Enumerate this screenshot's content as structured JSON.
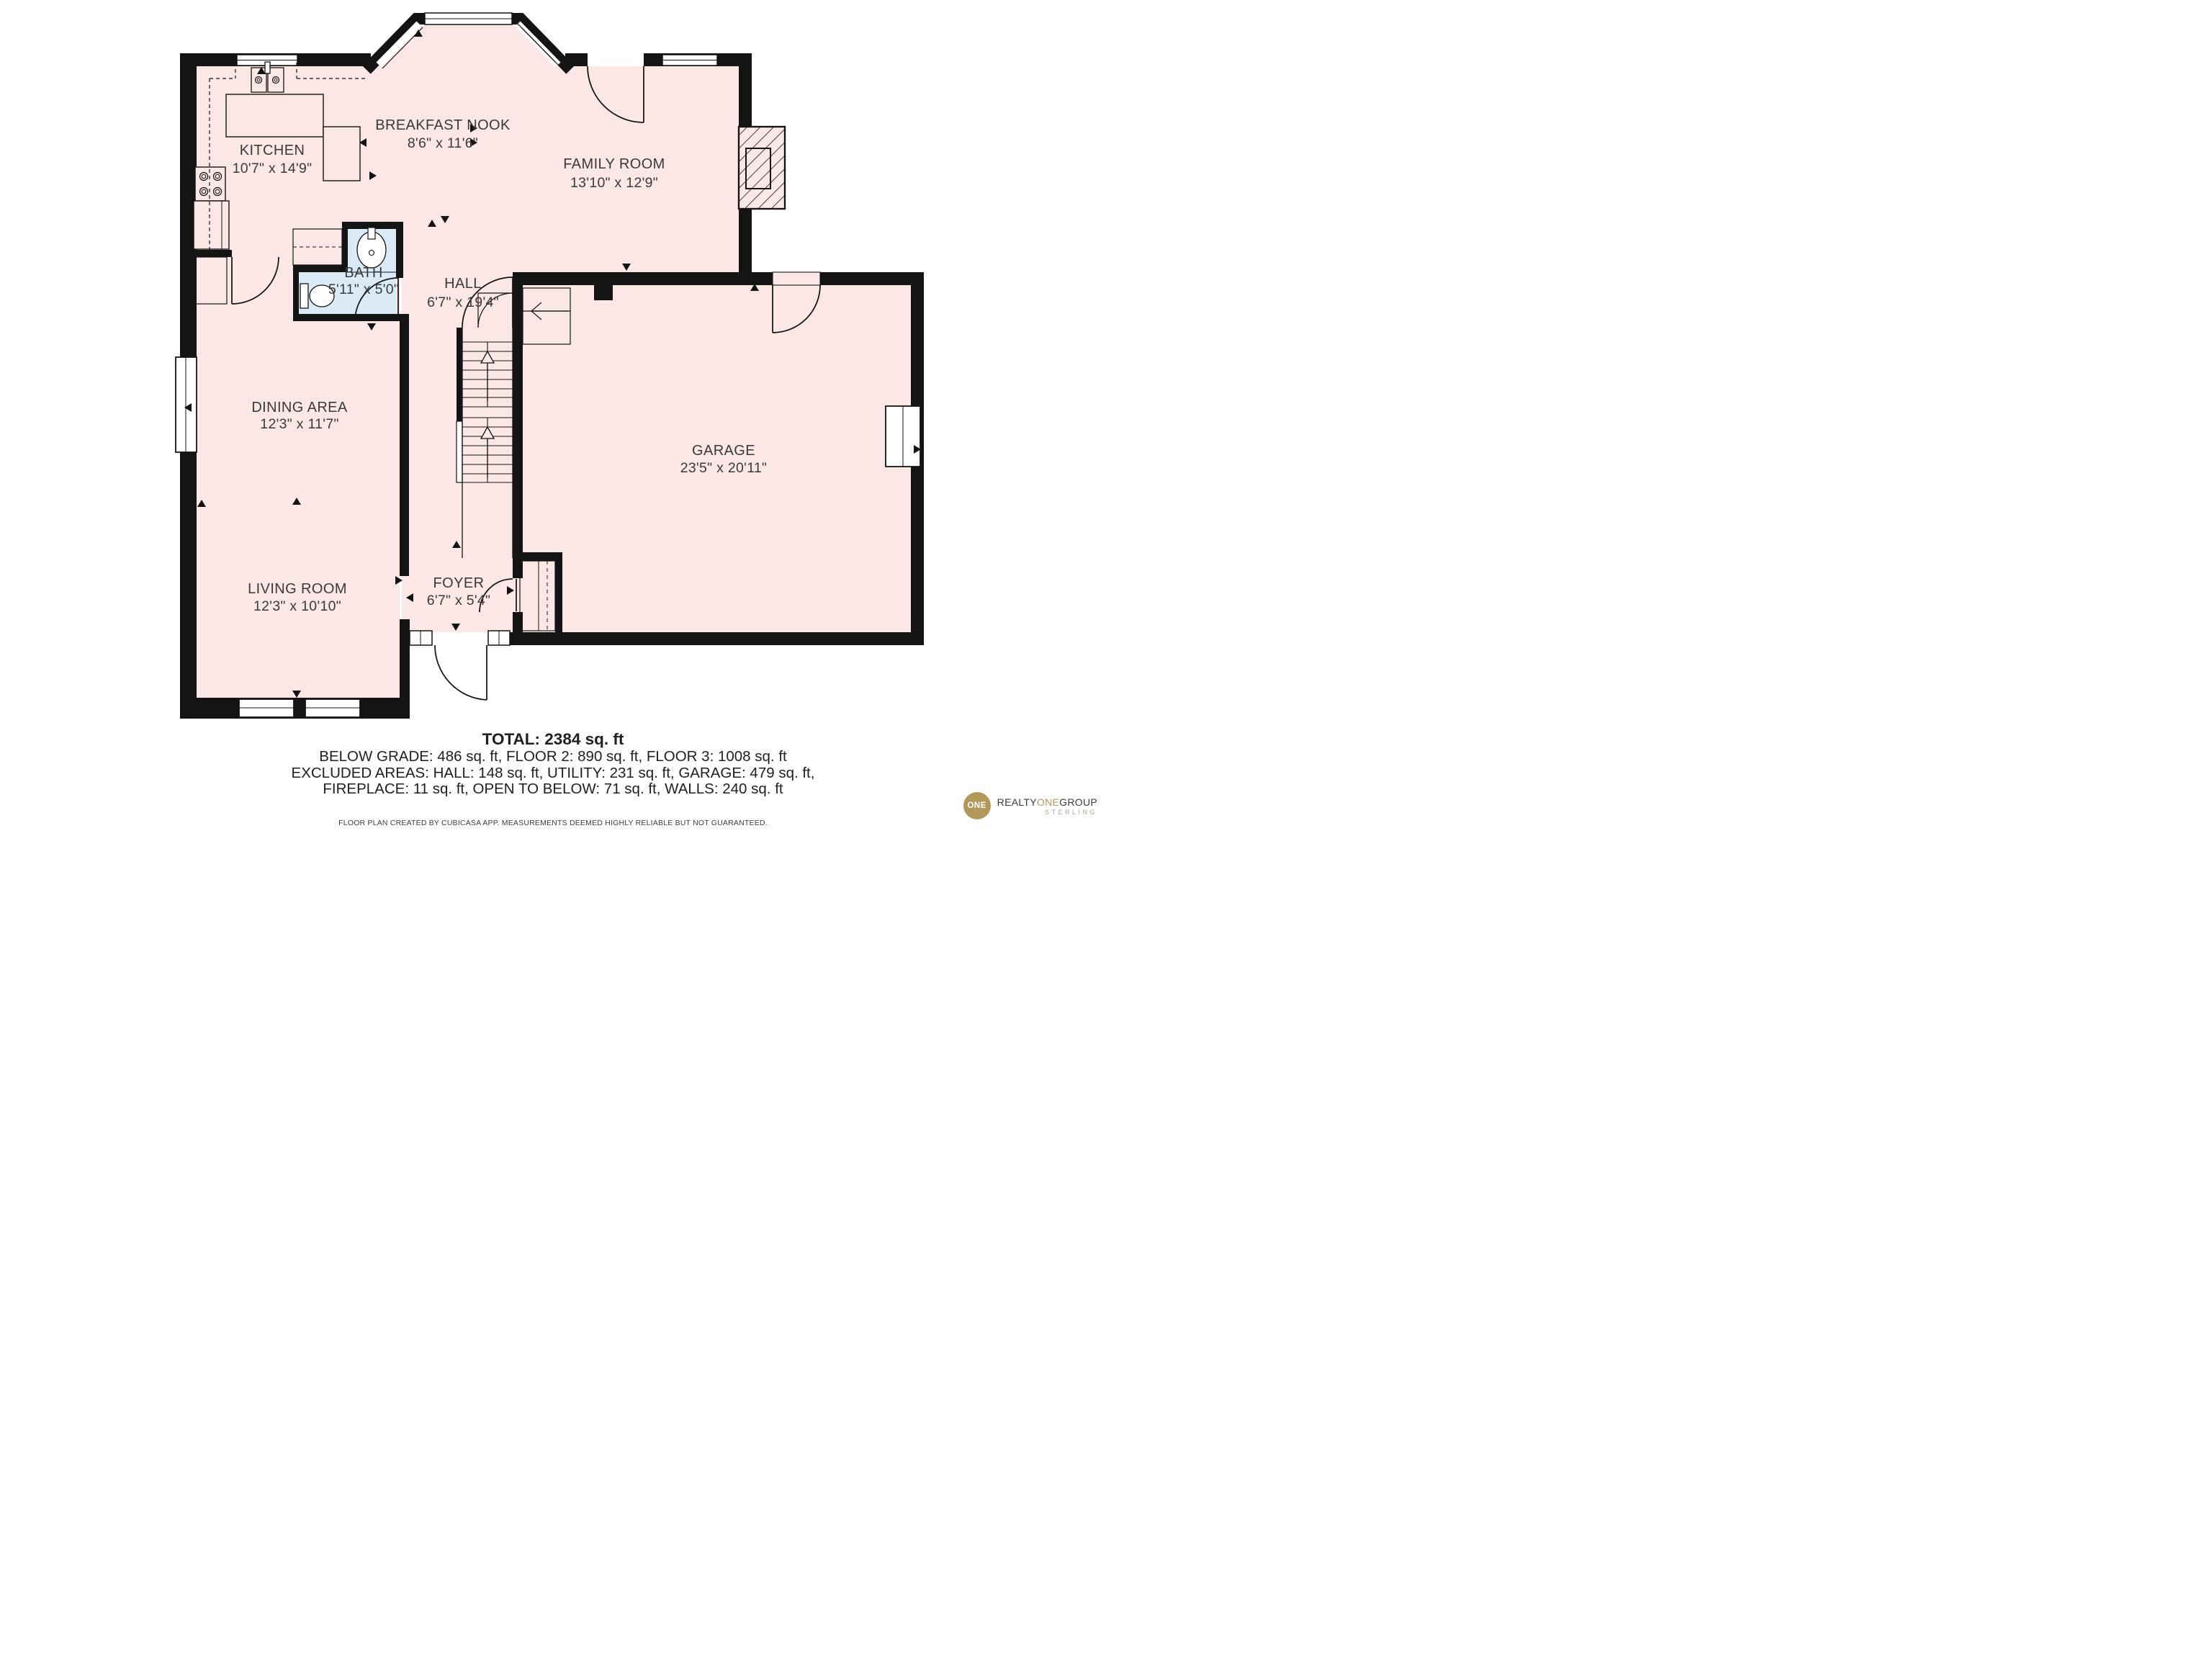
{
  "floor_plan": {
    "rooms": [
      {
        "name": "KITCHEN",
        "dims": "10'7\" x 14'9\""
      },
      {
        "name": "BREAKFAST NOOK",
        "dims": "8'6\" x 11'6\""
      },
      {
        "name": "FAMILY ROOM",
        "dims": "13'10\" x 12'9\""
      },
      {
        "name": "BATH",
        "dims": "5'11\" x 5'0\""
      },
      {
        "name": "HALL",
        "dims": "6'7\" x 19'4\""
      },
      {
        "name": "DINING AREA",
        "dims": "12'3\" x 11'7\""
      },
      {
        "name": "GARAGE",
        "dims": "23'5\" x 20'11\""
      },
      {
        "name": "LIVING ROOM",
        "dims": "12'3\" x 10'10\""
      },
      {
        "name": "FOYER",
        "dims": "6'7\" x 5'4\""
      }
    ],
    "fixtures": [
      "stove",
      "kitchen-sink",
      "counter",
      "island",
      "refrigerator",
      "pantry",
      "bay-window",
      "bath-sink",
      "toilet",
      "fireplace",
      "staircase",
      "stair-landing",
      "coat-closet"
    ],
    "colors": {
      "floor": "#fbe7e5",
      "bath_floor": "#daebf7",
      "wall": "#141414",
      "label_text": "#3a3a3a"
    }
  },
  "summary": {
    "total": "TOTAL: 2384 sq. ft",
    "lines": [
      "BELOW GRADE: 486 sq. ft, FLOOR 2: 890 sq. ft, FLOOR 3: 1008 sq. ft",
      "EXCLUDED AREAS: HALL: 148 sq. ft, UTILITY: 231 sq. ft, GARAGE: 479 sq. ft,",
      "FIREPLACE: 11 sq. ft, OPEN TO BELOW: 71 sq. ft, WALLS: 240 sq. ft"
    ]
  },
  "disclaimer": "FLOOR PLAN CREATED BY CUBICASA APP. MEASUREMENTS DEEMED HIGHLY RELIABLE BUT NOT GUARANTEED.",
  "logo": {
    "badge": "ONE",
    "realty": "REALTY",
    "one": "ONE",
    "group": "GROUP",
    "subtitle": "STERLING",
    "gold": "#b3985c",
    "dark": "#3e3a39",
    "subtitle_color": "#b3a78d"
  }
}
